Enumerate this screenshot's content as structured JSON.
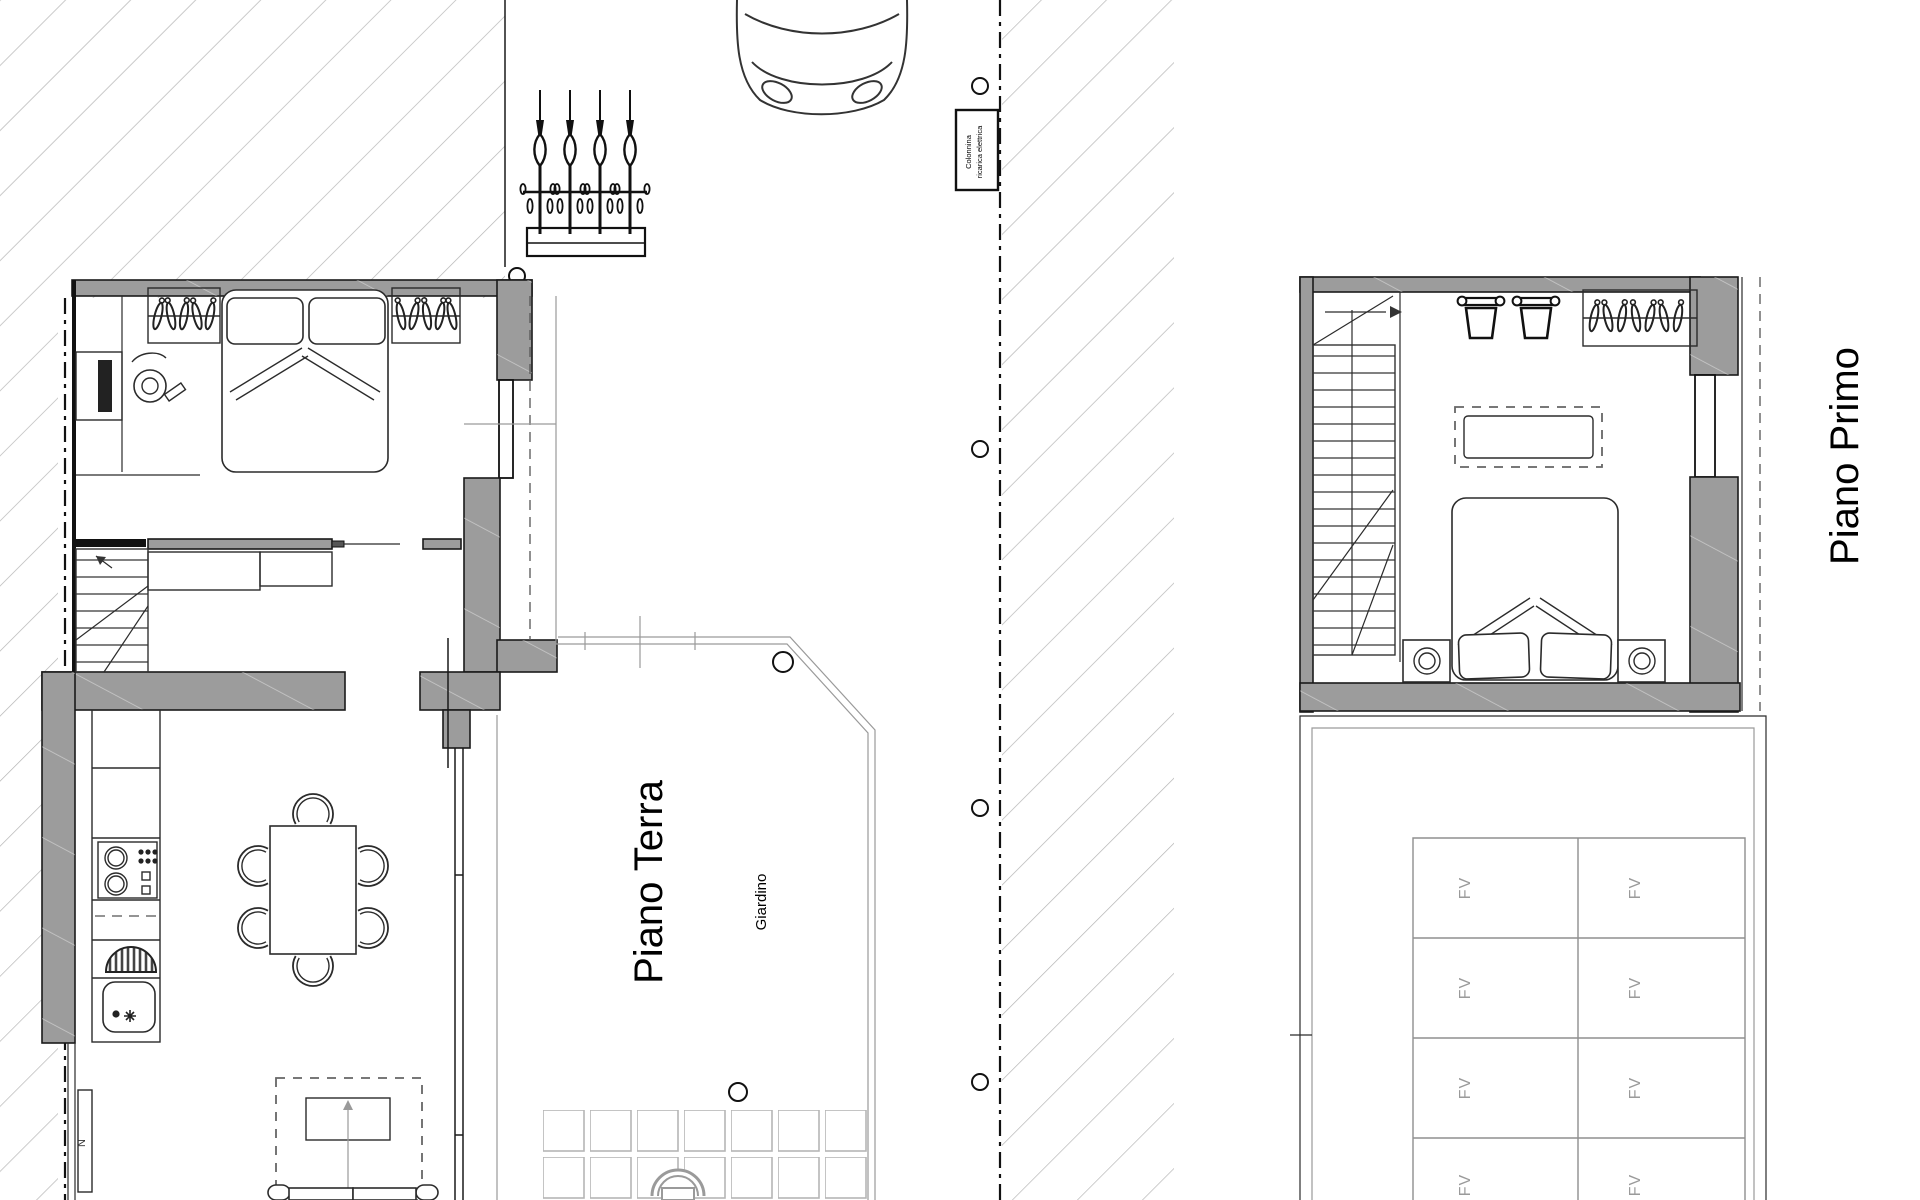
{
  "document": {
    "background": "#ffffff"
  },
  "labels": {
    "ground_floor": "Piano Terra",
    "first_floor": "Piano Primo",
    "garden": "Giardino",
    "solar_panel": "FV",
    "ev_charger_line1": "Colonnina",
    "ev_charger_line2": "ricarica elettrica",
    "wall_unit": "N"
  },
  "colors": {
    "wall_fill": "#9c9c9c",
    "hatch_line": "#b5b5b5",
    "outline": "#1a1a1a",
    "furniture_line": "#2b2b2b",
    "light_line": "#9a9a9a",
    "fv_text": "#9a9a9a",
    "label_text": "#000000"
  }
}
